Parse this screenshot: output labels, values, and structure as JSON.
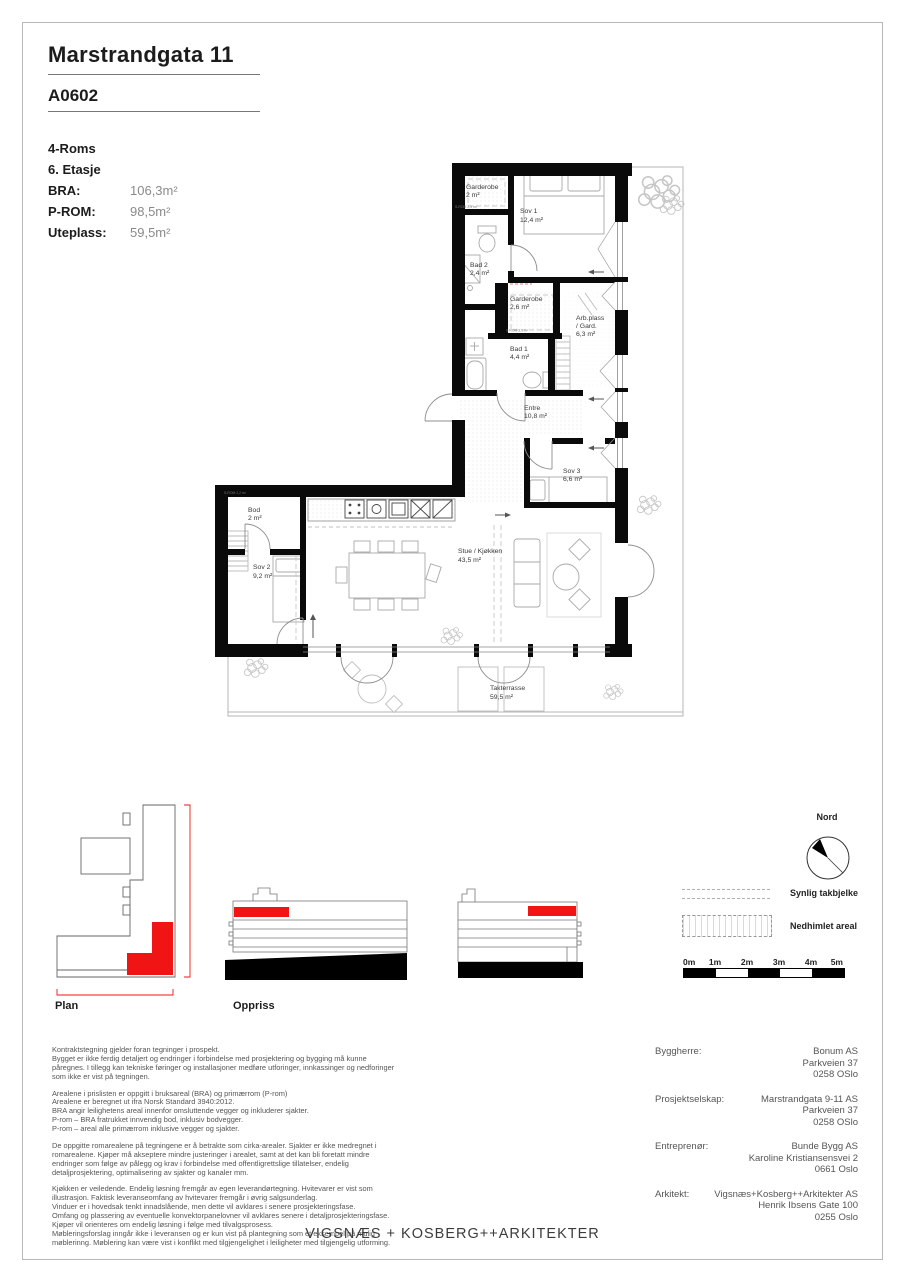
{
  "header": {
    "project_title": "Marstrandgata 11",
    "unit_id": "A0602"
  },
  "summary": {
    "rooms": "4-Roms",
    "floor": "6. Etasje",
    "metrics": [
      {
        "label": "BRA:",
        "value": "106,3m²"
      },
      {
        "label": "P-ROM:",
        "value": "98,5m²"
      },
      {
        "label": "Uteplass:",
        "value": "59,5m²"
      }
    ]
  },
  "floorplan": {
    "rooms": [
      {
        "name": "Garderobe",
        "area": "2 m²"
      },
      {
        "name": "Sov 1",
        "area": "12,4 m²"
      },
      {
        "name": "Bad 2",
        "area": "2,4 m²"
      },
      {
        "name": "Garderobe",
        "area": "2,6 m²"
      },
      {
        "name": "Arb.plass",
        "name2": "/ Gard.",
        "area": "6,3 m²"
      },
      {
        "name": "Bad 1",
        "area": "4,4 m²"
      },
      {
        "name": "Entre",
        "area": "10,8 m²"
      },
      {
        "name": "Sov 3",
        "area": "6,6 m²"
      },
      {
        "name": "Bod",
        "area": "2 m²"
      },
      {
        "name": "Sov 2",
        "area": "9,2 m²"
      },
      {
        "name": "Stue / Kjøkken",
        "area": "43,5 m²"
      },
      {
        "name": "Takterrasse",
        "area": "59,5 m²"
      }
    ],
    "small_labels": [
      "S-ROM 2,5 m²",
      "S-ROM 3,1 m²",
      "S-ROM 2,2 m²"
    ]
  },
  "drawings": {
    "plan_label": "Plan",
    "elevation_label": "Oppriss"
  },
  "north": {
    "label": "Nord"
  },
  "legend": {
    "items": [
      {
        "label": "Synlig takbjelke"
      },
      {
        "label": "Nedhimlet areal"
      }
    ]
  },
  "scalebar": {
    "ticks": [
      "0m",
      "1m",
      "2m",
      "3m",
      "4m",
      "5m"
    ]
  },
  "legal": {
    "paragraphs": [
      "Kontraktstegning gjelder foran tegninger i prospekt.\nBygget er ikke ferdig detaljert og endringer i forbindelse med prosjektering og bygging må kunne påregnes. I tillegg kan tekniske føringer og installasjoner medføre utforinger, innkassinger og nedforinger som ikke er vist på tegningen.",
      "Arealene i prislisten er oppgitt i bruksareal (BRA) og primærrom (P-rom)\nArealene er beregnet ut ifra Norsk Standard 3940:2012.\nBRA angir leilighetens areal innenfor omsluttende vegger og inkluderer sjakter.\nP-rom – BRA fratrukket innvendig bod, inklusiv bodvegger.\nP-rom – areal alle primærrom inklusive vegger og sjakter.",
      "De oppgitte romarealene på tegningene er å betrakte som cirka-arealer. Sjakter er ikke medregnet i romarealene. Kjøper må akseptere mindre justeringer i arealet, samt at det kan bli foretatt mindre endringer som følge av pålegg og krav i forbindelse med offentligrettslige tillatelser, endelig detaljprosjektering, optimalisering av sjakter og kanaler mm.",
      "Kjøkken er veiledende. Endelig løsning fremgår av egen leverandørtegning. Hvitevarer er vist som illustrasjon. Faktisk leveranseomfang av hvitevarer fremgår i øvrig salgsunderlag.\nVinduer er i hovedsak tenkt innadslående, men dette vil avklares i senere prosjekteringsfase.\nOmfang og plassering av eventuelle konvektorpanelovner vil avklares senere i detaljprosjekteringsfase. Kjøper vil orienteres om endelig løsning i følge med tilvalgsprosess.\nMøbleringsforslag inngår ikke i leveransen og er kun vist på plantegning som et eksempel på mulig møblerinng. Møblering kan være vist i konflikt med tilgjengelighet i leiligheter med tilgjengelig utforming."
    ]
  },
  "contacts": [
    {
      "role": "Byggherre:",
      "lines": [
        "Bonum AS",
        "Parkveien 37",
        "0258 OSlo"
      ]
    },
    {
      "role": "Prosjektselskap:",
      "lines": [
        "Marstrandgata 9-11 AS",
        "Parkveien 37",
        "0258 OSlo"
      ]
    },
    {
      "role": "Entreprenør:",
      "lines": [
        "Bunde Bygg AS",
        "Karoline Kristiansensvei 2",
        "0661 Oslo"
      ]
    },
    {
      "role": "Arkitekt:",
      "lines": [
        "Vigsnæs+Kosberg++Arkitekter AS",
        "Henrik Ibsens Gate 100",
        "0255 Oslo"
      ]
    }
  ],
  "footer": {
    "company": "VIGSNÆS + KOSBERG++ARKITEKTER"
  }
}
